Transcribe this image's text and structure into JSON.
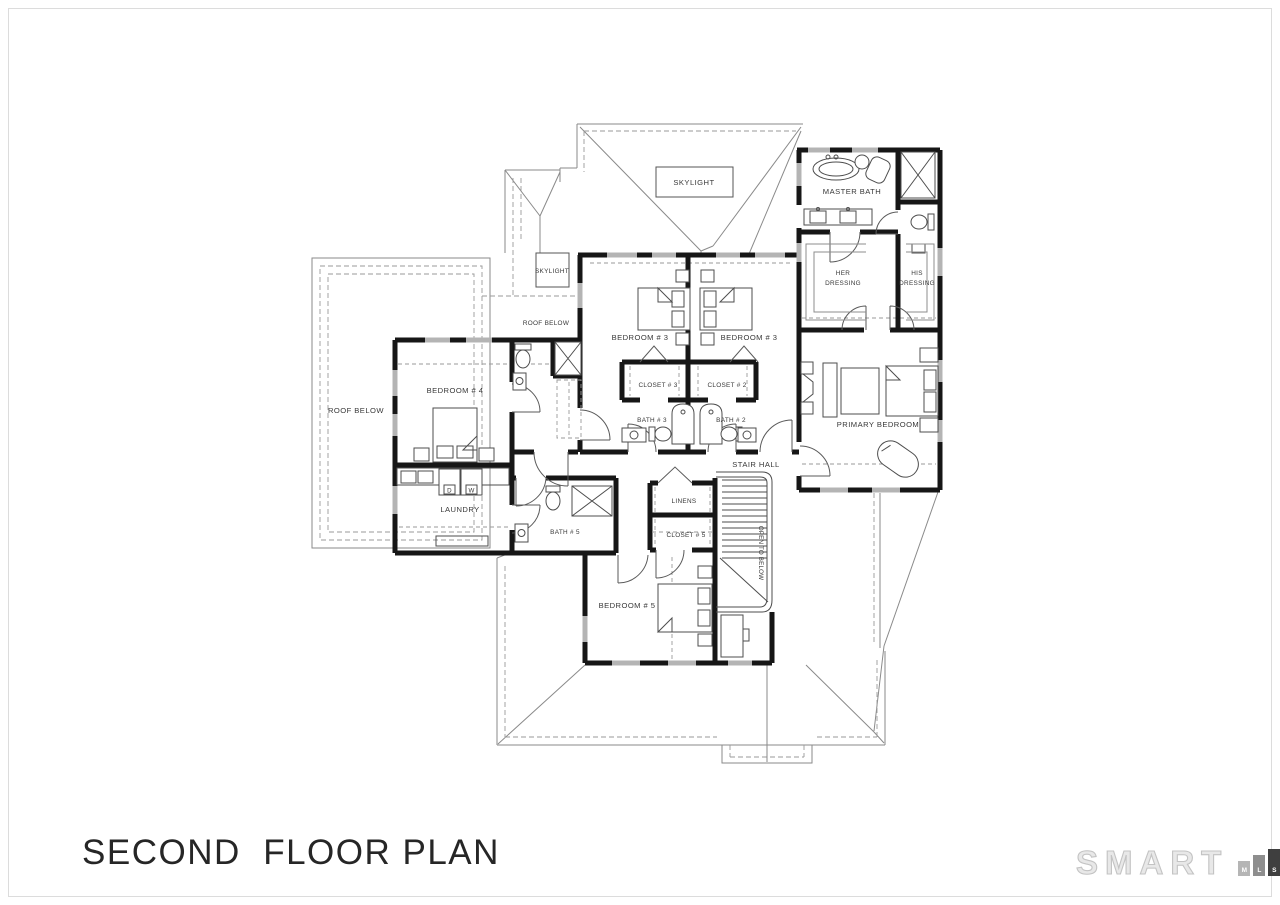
{
  "page": {
    "title": "SECOND  FLOOR PLAN"
  },
  "plan": {
    "rooms": {
      "master_bath": "MASTER BATH",
      "her_dressing": "HER DRESSING",
      "his_dressing": "HIS DRESSING",
      "bedroom3_left": "BEDROOM # 3",
      "bedroom3_right": "BEDROOM # 3",
      "closet3": "CLOSET # 3",
      "closet2": "CLOSET # 2",
      "bath3": "BATH # 3",
      "bath2": "BATH # 2",
      "bedroom4": "BEDROOM # 4",
      "laundry": "LAUNDRY",
      "bath5": "BATH # 5",
      "linens": "LINENS",
      "closet5": "CLOSET # 5",
      "stair_hall": "STAIR HALL",
      "open_to_below": "OPEN TO BELOW",
      "primary_bedroom": "PRIMARY BEDROOM",
      "bedroom5": "BEDROOM # 5"
    },
    "annotations": {
      "skylight_top": "SKYLIGHT",
      "skylight_small": "SKYLIGHT",
      "roof_below_upper": "ROOF BELOW",
      "roof_below_left": "ROOF BELOW",
      "dryer": "D",
      "washer": "W"
    }
  },
  "logo": {
    "brand": "SMART",
    "bars": [
      {
        "letter": "M",
        "color": "#b5b5b5"
      },
      {
        "letter": "L",
        "color": "#8e8e8e"
      },
      {
        "letter": "S",
        "color": "#3f3f3f"
      }
    ]
  },
  "colors": {
    "wall": "#161616",
    "window": "#b4b4b4",
    "roof_line": "#8a8a8a",
    "label": "#383838"
  }
}
